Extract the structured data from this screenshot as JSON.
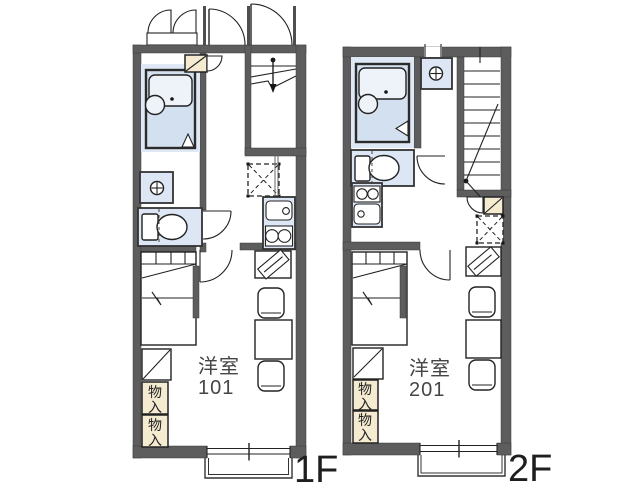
{
  "floors": [
    {
      "floor_label": "1F",
      "room": {
        "name": "洋室",
        "number": "101"
      },
      "storage": [
        {
          "label": "物入"
        },
        {
          "label": "物入"
        }
      ]
    },
    {
      "floor_label": "2F",
      "room": {
        "name": "洋室",
        "number": "201"
      },
      "storage": [
        {
          "label": "物入"
        },
        {
          "label": "物入"
        }
      ]
    }
  ],
  "colors": {
    "wall": "#5d5d5d",
    "wet_area_fill": "#dce6f4",
    "unit_bath_fill": "#d3e0f0",
    "storage_fill": "#f5ebd1",
    "line": "#222222",
    "room_text": "#454545",
    "floor_label_text": "#1e1e1e",
    "background": "#ffffff"
  }
}
